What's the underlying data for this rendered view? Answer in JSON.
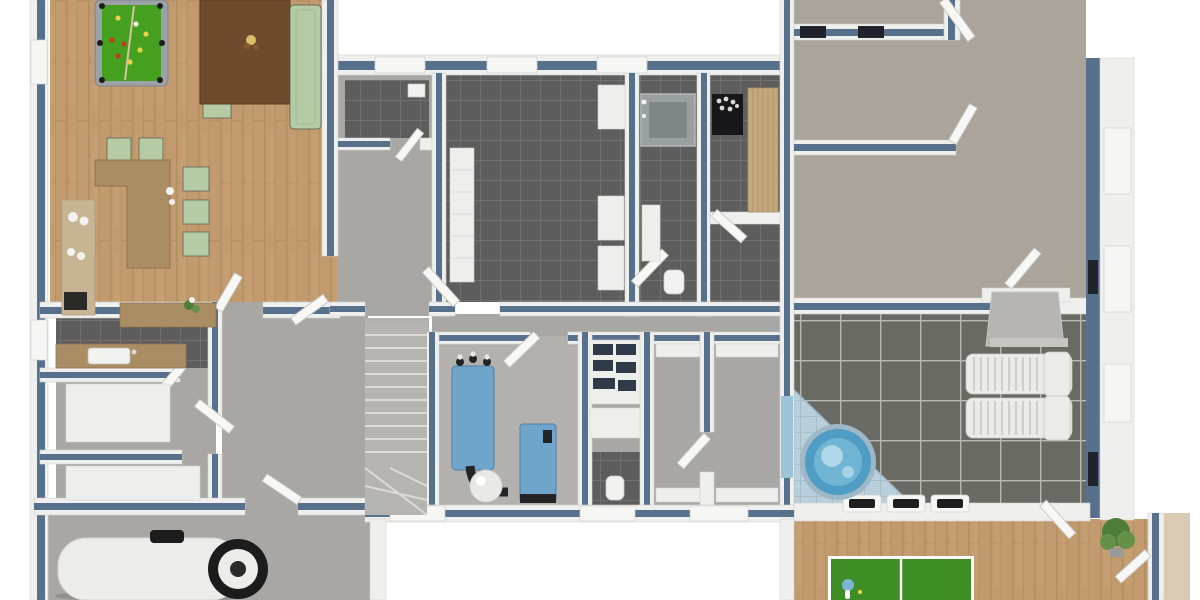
{
  "scene": {
    "type": "3d-floorplan-render",
    "view": "top-down birds-eye",
    "storey": "wellness-basement"
  },
  "colors": {
    "background": "#ffffff",
    "wall_cap": "#57708c",
    "wall_white": "#efefed",
    "wall_edge": "#d2d2cf",
    "door_leaf": "#f7f7f5",
    "door_edge": "#c5c5c2",
    "window_sill": "#f6f6f4",
    "window_dark": "#20242a",
    "window_frame": "#e3e3e0",
    "floor_wood": "#c19a6d",
    "floor_wood_dark": "#a87f52",
    "floor_wood_light": "#cfa87a",
    "tile_dark": "#5d5d5d",
    "tile_grout": "#707070",
    "tile_terrace": "#6a6a65",
    "tile_terrace_grout": "#b9b9b4",
    "pool_deck": "#b9cfdb",
    "pool_deck_line": "#a2bac8",
    "hot_tub_rim": "#9fb8c6",
    "hot_tub_water": "#4f9dc4",
    "hot_tub_ripple": "#8ccbe2",
    "hot_tub_foam": "#c8e4ef",
    "concrete": "#a8a7a3",
    "concrete_light": "#b2b1ad",
    "carpet": "#aaa49a",
    "billiard_frame": "#9ba1a7",
    "billiard_felt": "#44a01e",
    "billiard_pocket": "#1c1c1c",
    "cue": "#d8c49a",
    "table_walnut": "#6e4b2d",
    "seat_green": "#b5cba6",
    "seat_shadow": "#55554e",
    "counter_walnut": "#ab8d63",
    "counter_beige": "#c7b492",
    "appliance_dark": "#2a2a28",
    "sink_white": "#f2f2f0",
    "bench_white": "#eeeeec",
    "shower_glass": "#9aa0a2",
    "shower_base": "#7e8688",
    "sauna_heater": "#17171a",
    "sauna_stone": "#d7d7d4",
    "sauna_wood": "#c5a97e",
    "sauna_wood_dark": "#a98c60",
    "machine_blue": "#6fa5cb",
    "machine_blue_dark": "#4d7fa4",
    "pipe_dark": "#242426",
    "cylinder_white": "#e9e9e7",
    "shelf_box": "#2f3b49",
    "stair": "#b5b4b0",
    "stair_edge": "#dbdad6",
    "lounger": "#ebebe9",
    "lounger_slat": "#c7c7c4",
    "fireplace": "#b6b5b1",
    "fireplace_light": "#c6c5c1",
    "pingpong_top": "#3f8d25",
    "pingpong_line": "#ffffff",
    "paddle_blue": "#7db5d6",
    "ball_yellow": "#e8d24a",
    "ball_red": "#c23a24",
    "ball_white": "#f2f2ee",
    "plant_green": "#4e7d3a",
    "plant_green_light": "#639148",
    "pot_gray": "#9a9a96",
    "tank_body": "#ececea",
    "tank_dark": "#1c1c1c",
    "niche_dark": "#1f1f1f",
    "glass_door": "#9cc3d6",
    "exterior_tan": "#d8cab4"
  },
  "rooms": [
    {
      "id": "games-lounge",
      "floor": "wood"
    },
    {
      "id": "open-kitchen",
      "floor": "wood"
    },
    {
      "id": "kitchenette",
      "floor": "dark-tile"
    },
    {
      "id": "storage-1",
      "floor": "concrete"
    },
    {
      "id": "storage-2",
      "floor": "concrete"
    },
    {
      "id": "tank-room",
      "floor": "concrete"
    },
    {
      "id": "hallway",
      "floor": "concrete"
    },
    {
      "id": "wc",
      "floor": "dark-tile"
    },
    {
      "id": "changing-room",
      "floor": "dark-tile"
    },
    {
      "id": "shower-room",
      "floor": "dark-tile"
    },
    {
      "id": "sauna",
      "floor": "dark-tile"
    },
    {
      "id": "stairwell",
      "floor": "concrete"
    },
    {
      "id": "plant-room",
      "floor": "concrete"
    },
    {
      "id": "shelf-room",
      "floor": "concrete"
    },
    {
      "id": "storage-3",
      "floor": "concrete"
    },
    {
      "id": "storage-4",
      "floor": "concrete"
    },
    {
      "id": "room-right-1",
      "floor": "carpet"
    },
    {
      "id": "room-right-2",
      "floor": "carpet"
    },
    {
      "id": "corridor-right",
      "floor": "carpet"
    },
    {
      "id": "spa-terrace",
      "floor": "terrace-tile"
    },
    {
      "id": "table-tennis-room",
      "floor": "wood"
    }
  ],
  "furniture": [
    {
      "id": "billiard-table",
      "qty": 1
    },
    {
      "id": "billiard-balls",
      "qty": 10
    },
    {
      "id": "cue-stick",
      "qty": 1
    },
    {
      "id": "dining-table",
      "qty": 1
    },
    {
      "id": "dining-chair",
      "qty": 3
    },
    {
      "id": "sofa-bench",
      "qty": 1
    },
    {
      "id": "kitchen-island",
      "qty": 1
    },
    {
      "id": "bar-stool",
      "qty": 5
    },
    {
      "id": "wall-counter",
      "qty": 2
    },
    {
      "id": "kitchen-sink",
      "qty": 2
    },
    {
      "id": "lockers",
      "qty": 1
    },
    {
      "id": "bench",
      "qty": 4
    },
    {
      "id": "shower-cabin",
      "qty": 1
    },
    {
      "id": "sauna-heater",
      "qty": 1
    },
    {
      "id": "sauna-bench",
      "qty": 1
    },
    {
      "id": "hvac-unit",
      "qty": 2
    },
    {
      "id": "buffer-cylinder",
      "qty": 1
    },
    {
      "id": "storage-shelf",
      "qty": 1
    },
    {
      "id": "toilet",
      "qty": 1
    },
    {
      "id": "sun-lounger",
      "qty": 2
    },
    {
      "id": "hot-tub",
      "qty": 1
    },
    {
      "id": "fireplace",
      "qty": 1
    },
    {
      "id": "wall-niche",
      "qty": 3
    },
    {
      "id": "table-tennis-table",
      "qty": 1
    },
    {
      "id": "paddle",
      "qty": 1
    },
    {
      "id": "potted-plant",
      "qty": 1
    },
    {
      "id": "water-tank",
      "qty": 1
    },
    {
      "id": "staircase",
      "qty": 1
    },
    {
      "id": "open-door-leaf",
      "qty": 16
    }
  ]
}
